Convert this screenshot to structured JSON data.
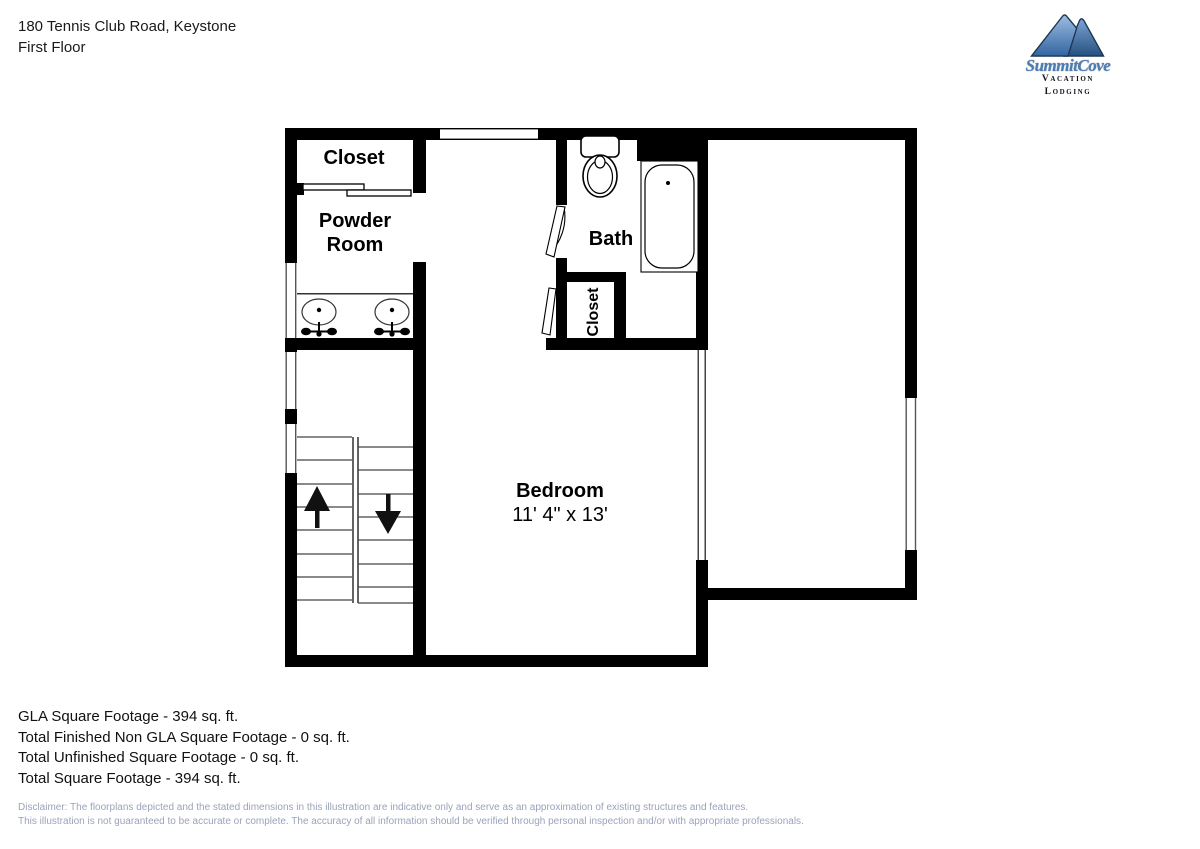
{
  "header": {
    "address": "180 Tennis Club Road, Keystone",
    "floor": "First Floor"
  },
  "logo": {
    "name": "SummitCove",
    "tagline": "Vacation Lodging"
  },
  "rooms": {
    "closet_top": {
      "label": "Closet"
    },
    "powder_room": {
      "label_line1": "Powder",
      "label_line2": "Room"
    },
    "bath": {
      "label": "Bath"
    },
    "closet_side": {
      "label": "Closet"
    },
    "bedroom": {
      "label": "Bedroom",
      "dimensions": "11' 4\" x 13'"
    }
  },
  "summary": {
    "lines": [
      "GLA Square Footage - 394 sq. ft.",
      "Total Finished Non GLA Square Footage - 0 sq. ft.",
      "Total Unfinished Square Footage - 0 sq. ft.",
      "Total Square Footage - 394 sq. ft."
    ]
  },
  "disclaimer": {
    "line1": "Disclaimer: The floorplans depicted and the stated dimensions in this illustration are indicative only and serve as an approximation of existing structures and features.",
    "line2": "This illustration is not guaranteed to be accurate or complete. The accuracy of all information should be verified through personal inspection and/or with appropriate professionals."
  },
  "colors": {
    "wall": "#000000",
    "disclaimer_text": "#9ba3ba",
    "logo_blue": "#4c7db2",
    "mountain_light": "#8fb3dd",
    "mountain_dark": "#2e5f97"
  }
}
